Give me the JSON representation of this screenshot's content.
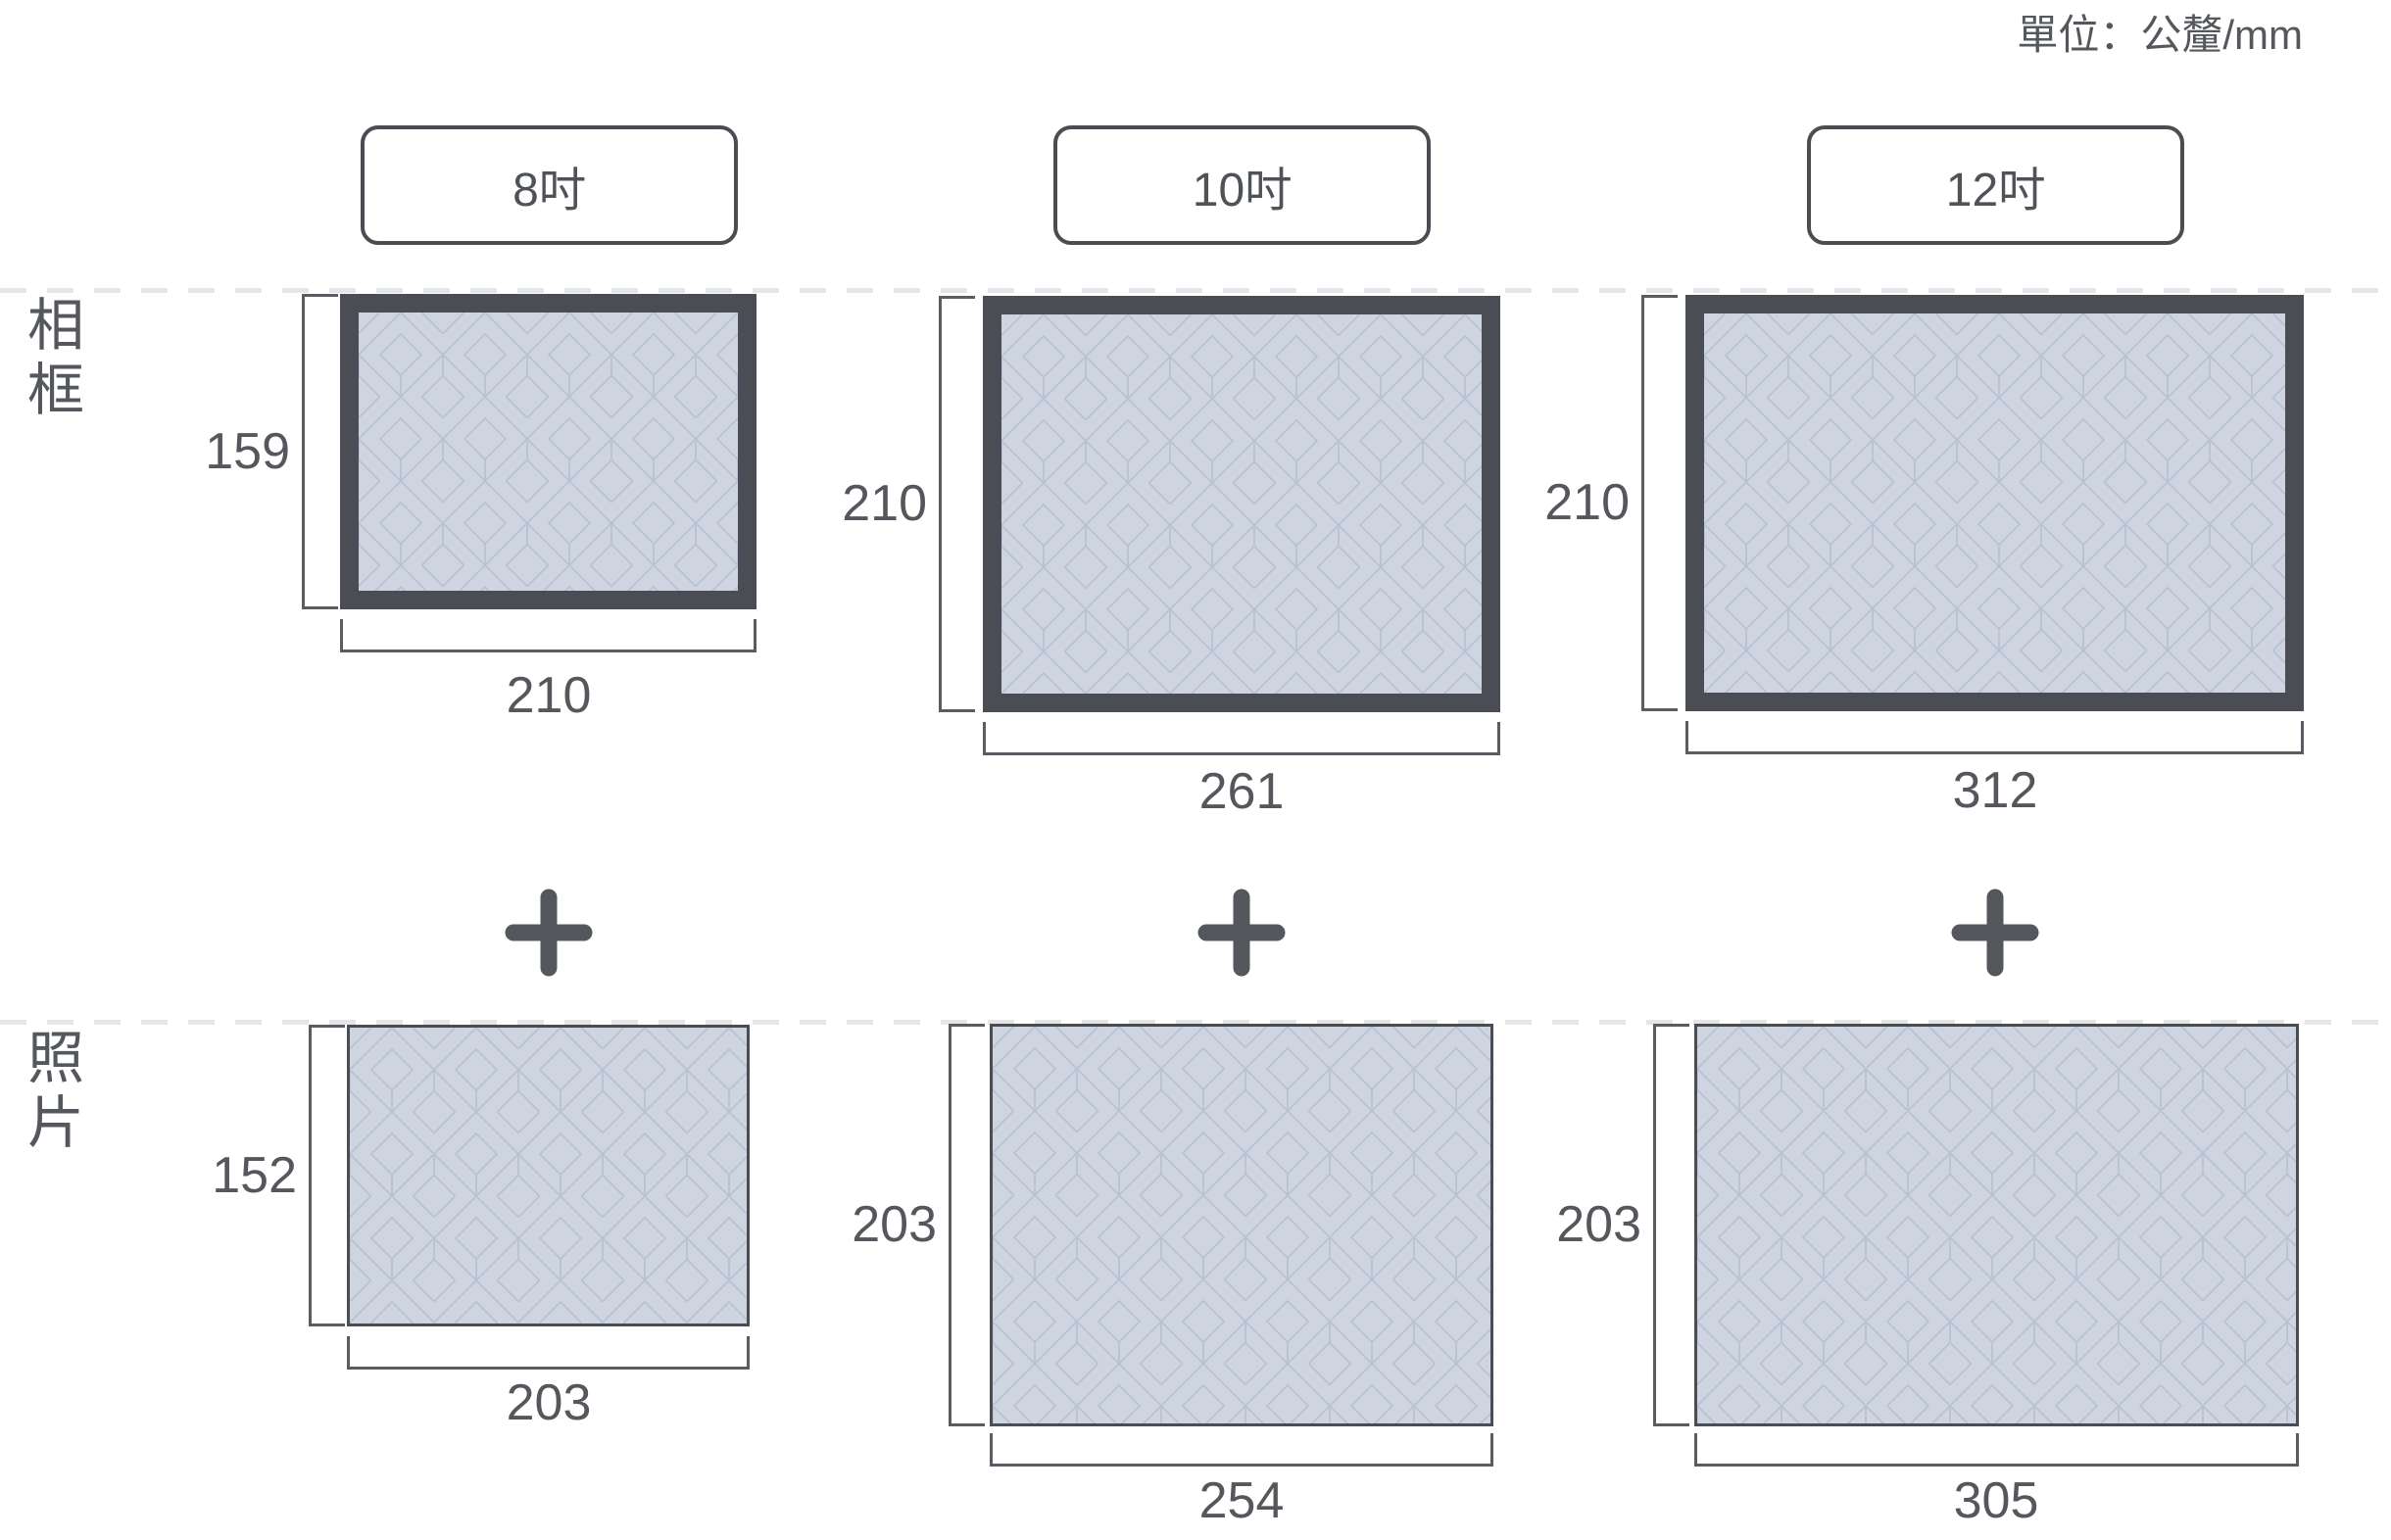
{
  "unit_label": "單位：公釐/mm",
  "rows": [
    {
      "label": "相框"
    },
    {
      "label": "照片"
    }
  ],
  "columns": [
    {
      "size_label": "8吋",
      "frame": {
        "height_mm": "159",
        "width_mm": "210"
      },
      "photo": {
        "height_mm": "152",
        "width_mm": "203"
      }
    },
    {
      "size_label": "10吋",
      "frame": {
        "height_mm": "210",
        "width_mm": "261"
      },
      "photo": {
        "height_mm": "203",
        "width_mm": "254"
      }
    },
    {
      "size_label": "12吋",
      "frame": {
        "height_mm": "210",
        "width_mm": "312"
      },
      "photo": {
        "height_mm": "203",
        "width_mm": "305"
      }
    }
  ],
  "icons": [
    "plus-icon",
    "plus-icon",
    "plus-icon"
  ],
  "colors": {
    "text": "#54575c",
    "frame_border": "#4a4e54",
    "pattern_fill": "#ced5e0",
    "pattern_line": "#b7c2d2",
    "bracket": "#595c61",
    "dashed_line": "#e5e6e8"
  }
}
